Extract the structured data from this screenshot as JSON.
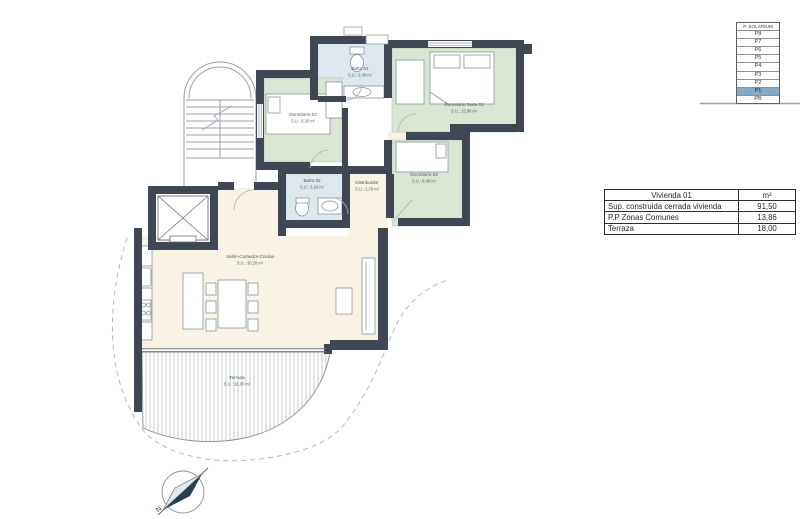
{
  "plan": {
    "rooms": [
      {
        "id": "bano-01",
        "name": "Baño 01",
        "area": "S.U.: 2,40 m²"
      },
      {
        "id": "dormitorio-suite-01",
        "name": "Dormitorio Suite 01",
        "area": "S.U.: 13,90 m²"
      },
      {
        "id": "dormitorio-02",
        "name": "Dormitorio 02",
        "area": "S.U.: 9,30 m²"
      },
      {
        "id": "dormitorio-03",
        "name": "Dormitorio 03",
        "area": "S.U.: 9,40 m²"
      },
      {
        "id": "bano-02",
        "name": "Baño 02",
        "area": "S.U.: 3,20 m²"
      },
      {
        "id": "distribuidor",
        "name": "Distribuidor",
        "area": "S.U.: 2,70 m²"
      },
      {
        "id": "salon",
        "name": "Salón-Comedor-Cocina",
        "area": "S.U.: 30,20 m²"
      },
      {
        "id": "terraza",
        "name": "Terraza",
        "area": "S.U.: 18,00 m²"
      }
    ],
    "compass": {
      "north_label": "N"
    }
  },
  "floor_stack": {
    "floors": [
      {
        "label": "P. SOLARIUM"
      },
      {
        "label": "P8"
      },
      {
        "label": "P7"
      },
      {
        "label": "P6"
      },
      {
        "label": "P5"
      },
      {
        "label": "P4"
      },
      {
        "label": "P3"
      },
      {
        "label": "P2"
      },
      {
        "label": "P1"
      },
      {
        "label": "PB"
      }
    ],
    "selected": "P1",
    "highlight_color": "#84aac8"
  },
  "area_table": {
    "header": {
      "title": "Vivienda 01",
      "unit": "m²"
    },
    "rows": [
      {
        "label": "Sup. construida cerrada vivienda",
        "value": "91,50"
      },
      {
        "label": "P.P Zonas Comunes",
        "value": "13,86"
      },
      {
        "label": "Terraza",
        "value": "18,00"
      }
    ]
  },
  "colors": {
    "wall": "#3e4753",
    "bedroom_fill": "#d9e6d3",
    "living_fill": "#f7f2e4",
    "bath_fill": "#dde7ee",
    "highlight": "#84aac8"
  }
}
